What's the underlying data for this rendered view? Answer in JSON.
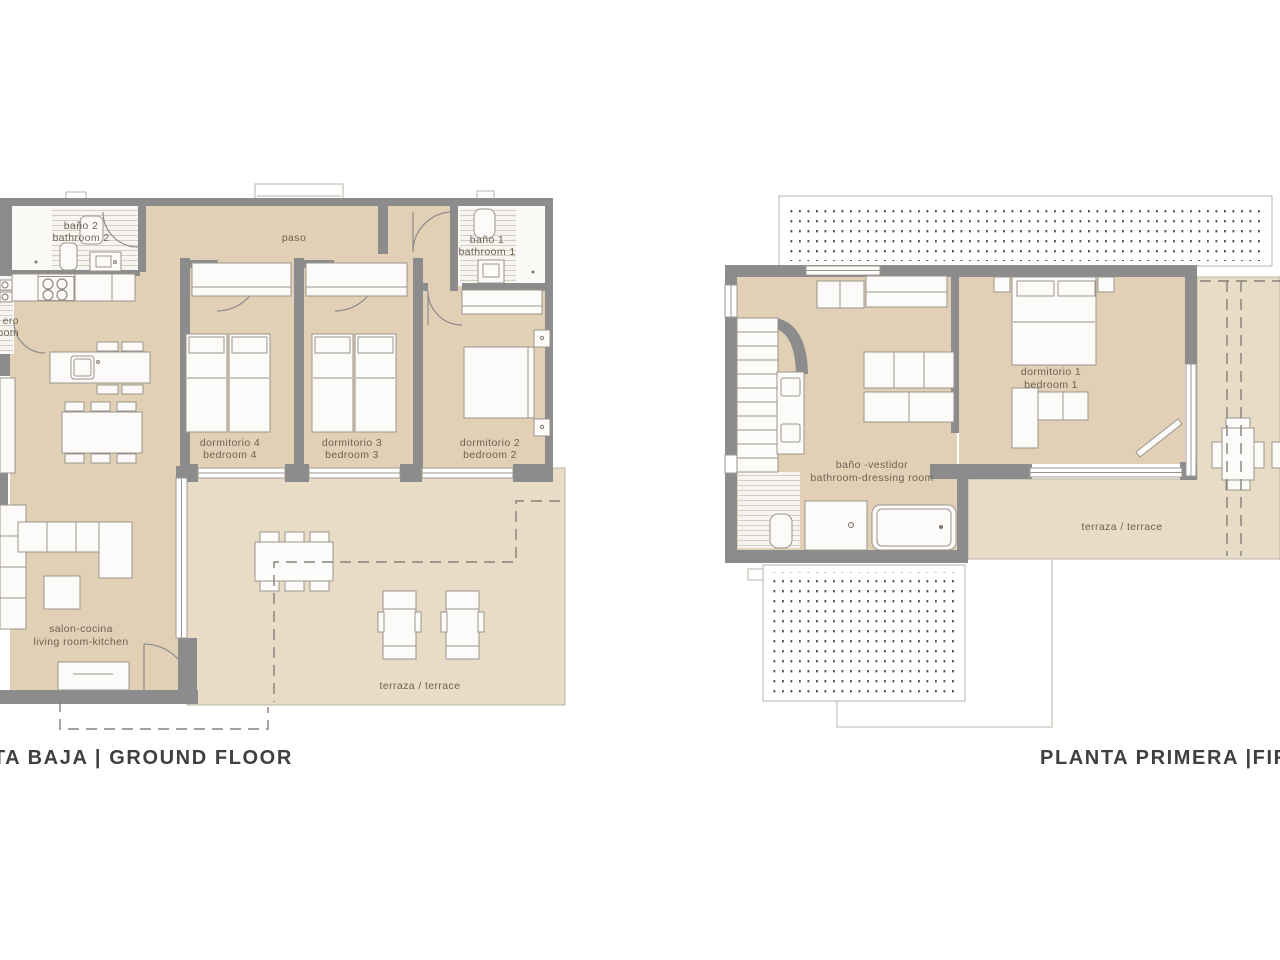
{
  "titles": {
    "ground": "PLANTA BAJA | GROUND FLOOR",
    "first": "PLANTA PRIMERA |FIRST FLOOR"
  },
  "ground": {
    "rooms": {
      "bathroom2": {
        "l1": "baño 2",
        "l2": "bathroom 2"
      },
      "laundry": {
        "l1": "ero",
        "l2": "oom"
      },
      "paso": {
        "l1": "paso"
      },
      "bathroom1": {
        "l1": "baño 1",
        "l2": "bathroom 1"
      },
      "bedroom4": {
        "l1": "dormitorio 4",
        "l2": "bedroom 4"
      },
      "bedroom3": {
        "l1": "dormitorio 3",
        "l2": "bedroom 3"
      },
      "bedroom2": {
        "l1": "dormitorio 2",
        "l2": "bedroom 2"
      },
      "living": {
        "l1": "salon-cocina",
        "l2": "living room-kitchen"
      },
      "terrace": {
        "l1": "terraza / terrace"
      }
    }
  },
  "first": {
    "rooms": {
      "bath_dressing": {
        "l1": "baño -vestidor",
        "l2": "bathroom-dressing room"
      },
      "bedroom1": {
        "l1": "dormitorio 1",
        "l2": "bedroom 1"
      },
      "terrace": {
        "l1": "terraza / terrace"
      }
    }
  },
  "colors": {
    "wall": "#8c8c8c",
    "floor": "#e2d0b6",
    "terrace": "#e8dcc6",
    "label_text": "#6b6254",
    "title_text": "#3f3f3f",
    "roof_dots": "#4f4f4f"
  }
}
